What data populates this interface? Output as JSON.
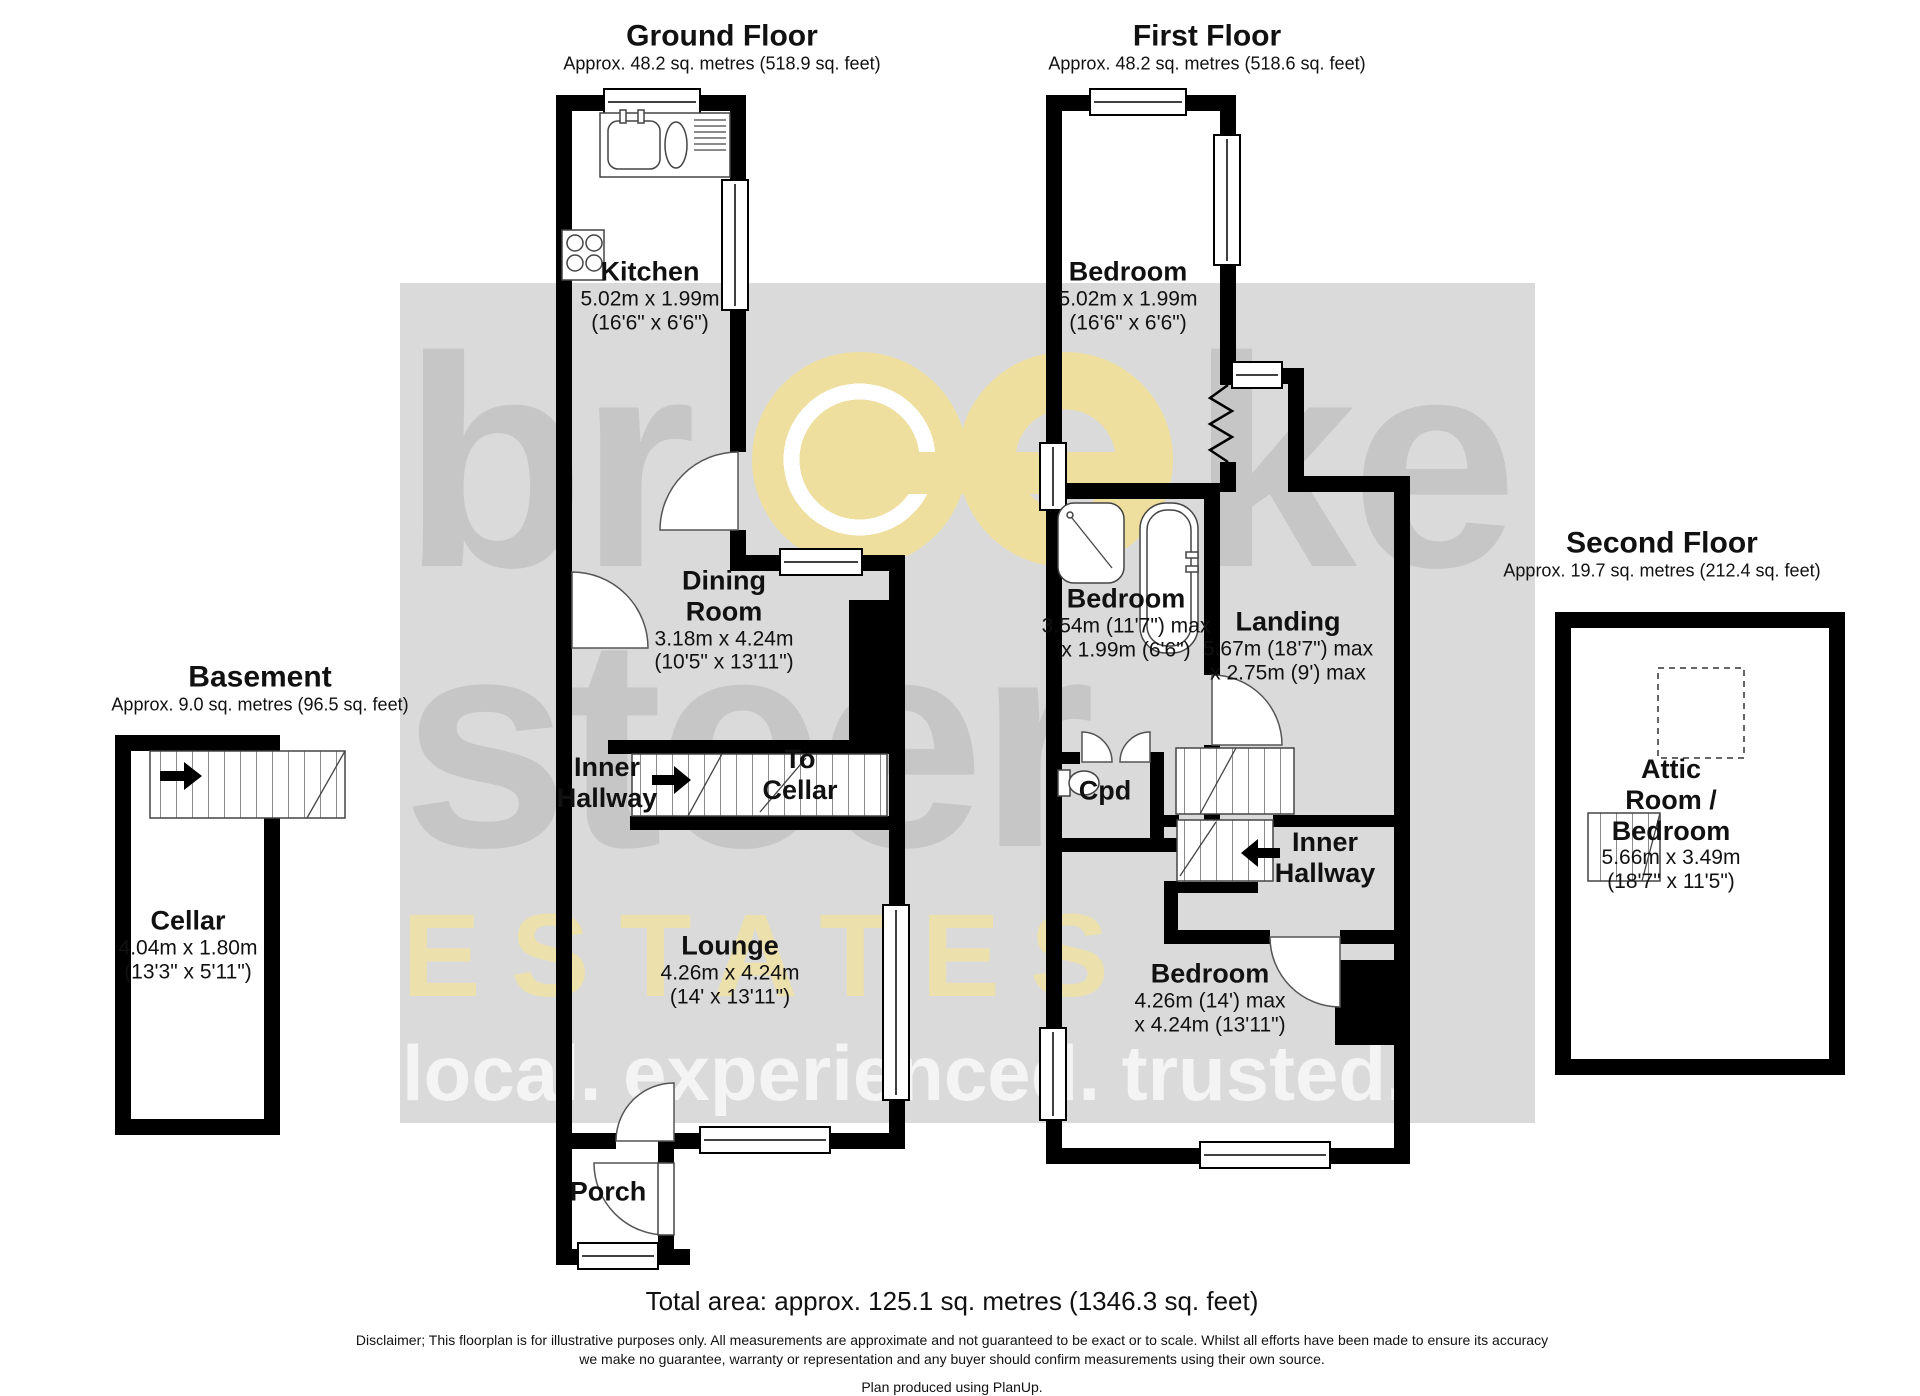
{
  "ground": {
    "title": "Ground Floor",
    "subtitle": "Approx. 48.2 sq. metres (518.9 sq. feet)",
    "rooms": {
      "kitchen": {
        "name": "Kitchen",
        "dims1": "5.02m x 1.99m",
        "dims2": "(16'6\" x 6'6\")"
      },
      "dining": {
        "name": "Dining Room",
        "dims1": "3.18m x 4.24m",
        "dims2": "(10'5\" x 13'11\")"
      },
      "inner_hallway": {
        "name": "Inner Hallway"
      },
      "to_cellar": {
        "name": "To Cellar"
      },
      "lounge": {
        "name": "Lounge",
        "dims1": "4.26m x 4.24m",
        "dims2": "(14' x 13'11\")"
      },
      "porch": {
        "name": "Porch"
      }
    }
  },
  "first": {
    "title": "First Floor",
    "subtitle": "Approx. 48.2 sq. metres (518.6 sq. feet)",
    "rooms": {
      "bedroom_front": {
        "name": "Bedroom",
        "dims1": "5.02m x 1.99m",
        "dims2": "(16'6\" x 6'6\")"
      },
      "bedroom_middle": {
        "name": "Bedroom",
        "dims1": "3.54m (11'7\") max",
        "dims2": "x 1.99m (6'6\")"
      },
      "landing": {
        "name": "Landing",
        "dims1": "5.67m (18'7\") max",
        "dims2": "x 2.75m (9') max"
      },
      "cupboard": {
        "name": "Cpd"
      },
      "inner_hallway": {
        "name": "Inner Hallway"
      },
      "bedroom_rear": {
        "name": "Bedroom",
        "dims1": "4.26m (14') max",
        "dims2": "x 4.24m (13'11\")"
      }
    }
  },
  "basement": {
    "title": "Basement",
    "subtitle": "Approx. 9.0 sq. metres (96.5 sq. feet)",
    "rooms": {
      "cellar": {
        "name": "Cellar",
        "dims1": "4.04m x 1.80m",
        "dims2": "(13'3\" x 5'11\")"
      }
    }
  },
  "second": {
    "title": "Second Floor",
    "subtitle": "Approx. 19.7 sq. metres (212.4 sq. feet)",
    "rooms": {
      "attic": {
        "name": "Attic Room / Bedroom",
        "dims1": "5.66m x 3.49m",
        "dims2": "(18'7\" x 11'5\")"
      }
    }
  },
  "watermark": {
    "brand_left": "br",
    "brand_right": "ke",
    "brand_bottom": "steer",
    "estates": "ESTATES",
    "tagline": "local. experienced. trusted."
  },
  "icons": {
    "gf_stairs_arrow": "arrow-right",
    "ff_stairs_arrow": "arrow-left",
    "basement_stairs_arrow": "arrow-right"
  },
  "colors": {
    "wall": "#000000",
    "watermark_band": "#dadada",
    "watermark_letters": "#c6c6c6",
    "watermark_yellow": "#efdf9f",
    "text": "#111111"
  },
  "footer": {
    "total": "Total area: approx. 125.1 sq. metres (1346.3 sq. feet)",
    "disclaimer1": "Disclaimer; This floorplan is for illustrative purposes only. All measurements are approximate and not guaranteed to be exact or to scale. Whilst all efforts have been made to ensure its accuracy",
    "disclaimer2": "we make no guarantee, warranty or representation and any buyer should confirm measurements using their own source.",
    "produced": "Plan produced using PlanUp."
  }
}
